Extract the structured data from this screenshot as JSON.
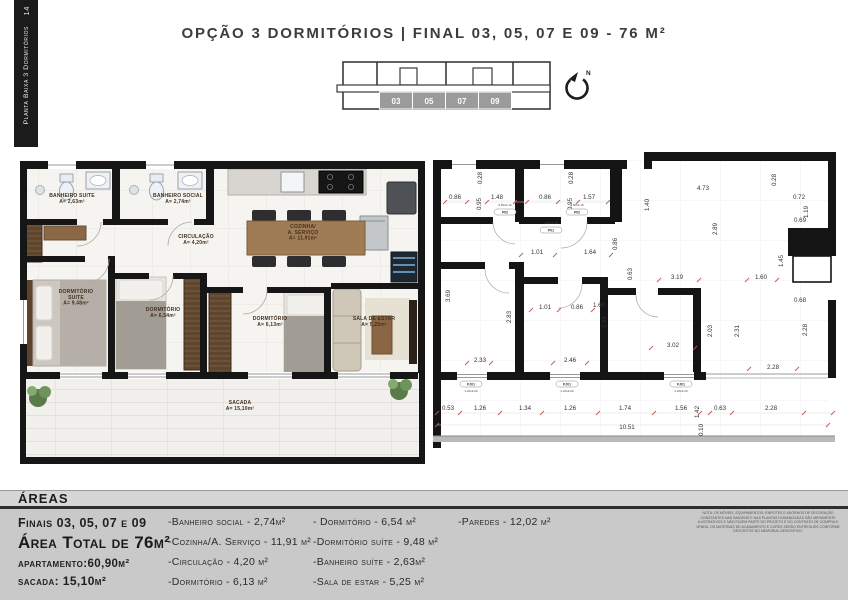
{
  "page": {
    "title": "OPÇÃO 3 DORMITÓRIOS |  FINAL 03, 05, 07 E 09 - 76 M²"
  },
  "sidebar": {
    "page_number": "14",
    "label": "Planta Baixa 3 Dormitórios"
  },
  "key_plan": {
    "units": [
      "03",
      "05",
      "07",
      "09"
    ],
    "highlight_color": "#9b9b9b"
  },
  "north": {
    "label": "N"
  },
  "left_plan": {
    "rooms": [
      {
        "name": "BANHEIRO SUITE",
        "area": "A= 2,63m²",
        "x": 72,
        "y": 197
      },
      {
        "name": "BANHEIRO SOCIAL",
        "area": "A= 2,74m²",
        "x": 178,
        "y": 197
      },
      {
        "name": "CIRCULAÇÃO",
        "area": "A= 4,20m²",
        "x": 196,
        "y": 238
      },
      {
        "name": "COZINHA/",
        "name2": "A. SERVIÇO",
        "area": "A= 11,91m²",
        "x": 303,
        "y": 228
      },
      {
        "name": "DORMITÓRIO",
        "name2": "SUITE",
        "area": "A= 9,48m²",
        "x": 76,
        "y": 293
      },
      {
        "name": "DORMITÓRIO",
        "area": "A= 6,54m²",
        "x": 163,
        "y": 311
      },
      {
        "name": "DORMITÓRIO",
        "area": "A= 6,13m²",
        "x": 270,
        "y": 320
      },
      {
        "name": "SALA DE ESTAR",
        "area": "A= 5,25m²",
        "x": 374,
        "y": 320
      },
      {
        "name": "SACADA",
        "area": "A= 15,10m²",
        "x": 240,
        "y": 404
      }
    ]
  },
  "right_plan": {
    "dims": [
      {
        "t": "0.86",
        "x": 455,
        "y": 199
      },
      {
        "t": "0.28",
        "x": 482,
        "y": 178,
        "r": 1
      },
      {
        "t": "0.95",
        "x": 481,
        "y": 204,
        "r": 1
      },
      {
        "t": "1.48",
        "x": 497,
        "y": 199
      },
      {
        "t": "0.86",
        "x": 545,
        "y": 199
      },
      {
        "t": "0.28",
        "x": 573,
        "y": 178,
        "r": 1
      },
      {
        "t": "0.95",
        "x": 572,
        "y": 204,
        "r": 1
      },
      {
        "t": "1.57",
        "x": 589,
        "y": 199
      },
      {
        "t": "1.40",
        "x": 649,
        "y": 205,
        "r": 1
      },
      {
        "t": "4.73",
        "x": 703,
        "y": 190
      },
      {
        "t": "0.28",
        "x": 776,
        "y": 180,
        "r": 1
      },
      {
        "t": "0.72",
        "x": 799,
        "y": 199
      },
      {
        "t": "1.19",
        "x": 808,
        "y": 212,
        "r": 1
      },
      {
        "t": "0.69",
        "x": 800,
        "y": 222
      },
      {
        "t": "2.89",
        "x": 717,
        "y": 229,
        "r": 1
      },
      {
        "t": "1.45",
        "x": 783,
        "y": 261,
        "r": 1
      },
      {
        "t": "1.01",
        "x": 537,
        "y": 254
      },
      {
        "t": "1.64",
        "x": 590,
        "y": 254
      },
      {
        "t": "0.86",
        "x": 617,
        "y": 244,
        "r": 1
      },
      {
        "t": "0.63",
        "x": 632,
        "y": 274,
        "r": 1
      },
      {
        "t": "3.19",
        "x": 677,
        "y": 279
      },
      {
        "t": "1.60",
        "x": 761,
        "y": 279
      },
      {
        "t": "3.69",
        "x": 450,
        "y": 296,
        "r": 1
      },
      {
        "t": "2.83",
        "x": 511,
        "y": 317,
        "r": 1
      },
      {
        "t": "1.01",
        "x": 545,
        "y": 309
      },
      {
        "t": "0.86",
        "x": 577,
        "y": 309
      },
      {
        "t": "1.60",
        "x": 599,
        "y": 307
      },
      {
        "t": "2.66",
        "x": 606,
        "y": 322,
        "r": 1
      },
      {
        "t": "2.33",
        "x": 480,
        "y": 362
      },
      {
        "t": "2.46",
        "x": 570,
        "y": 362
      },
      {
        "t": "2.03",
        "x": 712,
        "y": 331,
        "r": 1
      },
      {
        "t": "2.31",
        "x": 739,
        "y": 331,
        "r": 1
      },
      {
        "t": "3.02",
        "x": 673,
        "y": 347
      },
      {
        "t": "0.68",
        "x": 800,
        "y": 302
      },
      {
        "t": "2.28",
        "x": 807,
        "y": 330,
        "r": 1
      },
      {
        "t": "2.28",
        "x": 773,
        "y": 369
      },
      {
        "t": "0.53",
        "x": 448,
        "y": 410
      },
      {
        "t": "1.26",
        "x": 480,
        "y": 410
      },
      {
        "t": "1.34",
        "x": 525,
        "y": 410
      },
      {
        "t": "1.26",
        "x": 570,
        "y": 410
      },
      {
        "t": "1.74",
        "x": 625,
        "y": 410
      },
      {
        "t": "1.56",
        "x": 681,
        "y": 410
      },
      {
        "t": "1.42",
        "x": 699,
        "y": 412,
        "r": 1
      },
      {
        "t": "0.63",
        "x": 720,
        "y": 410
      },
      {
        "t": "2.28",
        "x": 771,
        "y": 410
      },
      {
        "t": "10.51",
        "x": 627,
        "y": 429
      },
      {
        "t": "0.10",
        "x": 703,
        "y": 430,
        "r": 1
      }
    ],
    "tags": [
      {
        "code": "P02",
        "size": "0.80x2.10",
        "x": 505,
        "y": 209,
        "o": "d"
      },
      {
        "code": "P02",
        "size": "0.80x2.10",
        "x": 577,
        "y": 209,
        "o": "d"
      },
      {
        "code": "P01",
        "size": "0.80x2.10",
        "x": 551,
        "y": 227,
        "o": "d"
      },
      {
        "code": "PJ01",
        "size": "1.20x2.20",
        "x": 471,
        "y": 385,
        "o": "w"
      },
      {
        "code": "PJ01",
        "size": "1.20x2.20",
        "x": 567,
        "y": 385,
        "o": "w"
      },
      {
        "code": "PJ01",
        "size": "1.20x2.20",
        "x": 681,
        "y": 385,
        "o": "w"
      }
    ]
  },
  "areas": {
    "heading": "ÁREAS",
    "finais": "Finais 03, 05, 07 e 09",
    "total": "Área Total de 76m²",
    "apartamento": "apartamento:60,90m²",
    "sacada": "sacada: 15,10m²",
    "col1": [
      "-Banheiro social - 2,74m²",
      "-Cozinha/A. Serviço - 11,91 m²",
      "-Circulação - 4,20 m²",
      "-Dormitório - 6,13 m²"
    ],
    "col2": [
      "- Dormitório - 6,54 m²",
      "-Dormitório suíte - 9,48 m²",
      "-Banheiro suíte - 2,63m²",
      "-Sala de estar - 5,25 m²"
    ],
    "col3": [
      "-Paredes - 12,02 m²"
    ],
    "note": "NOTA: Os móveis, equipamentos, enfeites e adornos de decoração constantes nas imagens e nas plantas humanizadas são meramente ilustrativos e não fazem parte do projeto e do contrato de compra e venda. Os materiais de acabamento e cores serão entregues conforme descritos no memorial descritivo."
  }
}
